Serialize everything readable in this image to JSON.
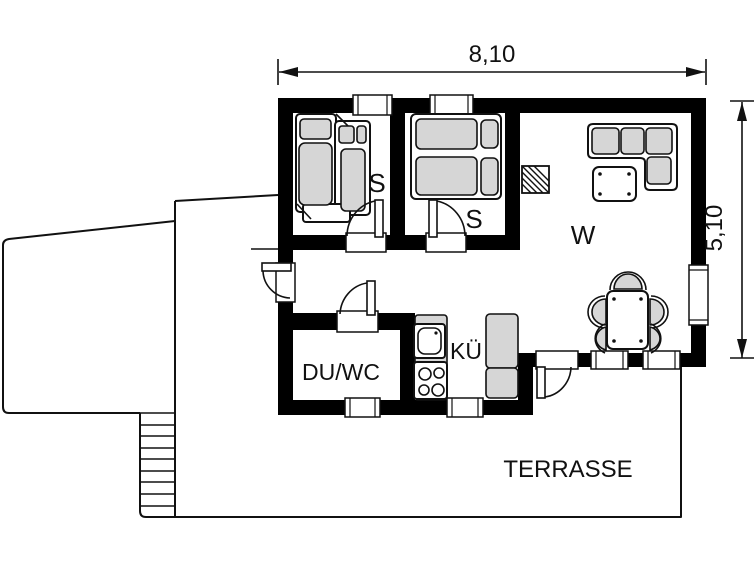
{
  "floor_plan": {
    "dimensions": {
      "width": "8,10",
      "depth": "5,10"
    },
    "rooms": {
      "bedroom_left": {
        "label": "S"
      },
      "bedroom_right": {
        "label": "S"
      },
      "living_room": {
        "label": "W"
      },
      "kitchen": {
        "label": "KÜ"
      },
      "shower_wc": {
        "label": "DU/WC"
      },
      "terrace": {
        "label": "TERRASSE"
      }
    },
    "colors": {
      "walls": "#000000",
      "upholstery": "#d6d6d6",
      "background": "#ffffff",
      "linework": "#111111"
    },
    "fixtures": [
      "sofa-bed",
      "double-bed",
      "corner-sofa",
      "coffee-table",
      "wood-stove",
      "dining-table",
      "dining-chairs",
      "kitchen-sink",
      "cooktop",
      "refrigerator",
      "exterior-stairs"
    ]
  }
}
